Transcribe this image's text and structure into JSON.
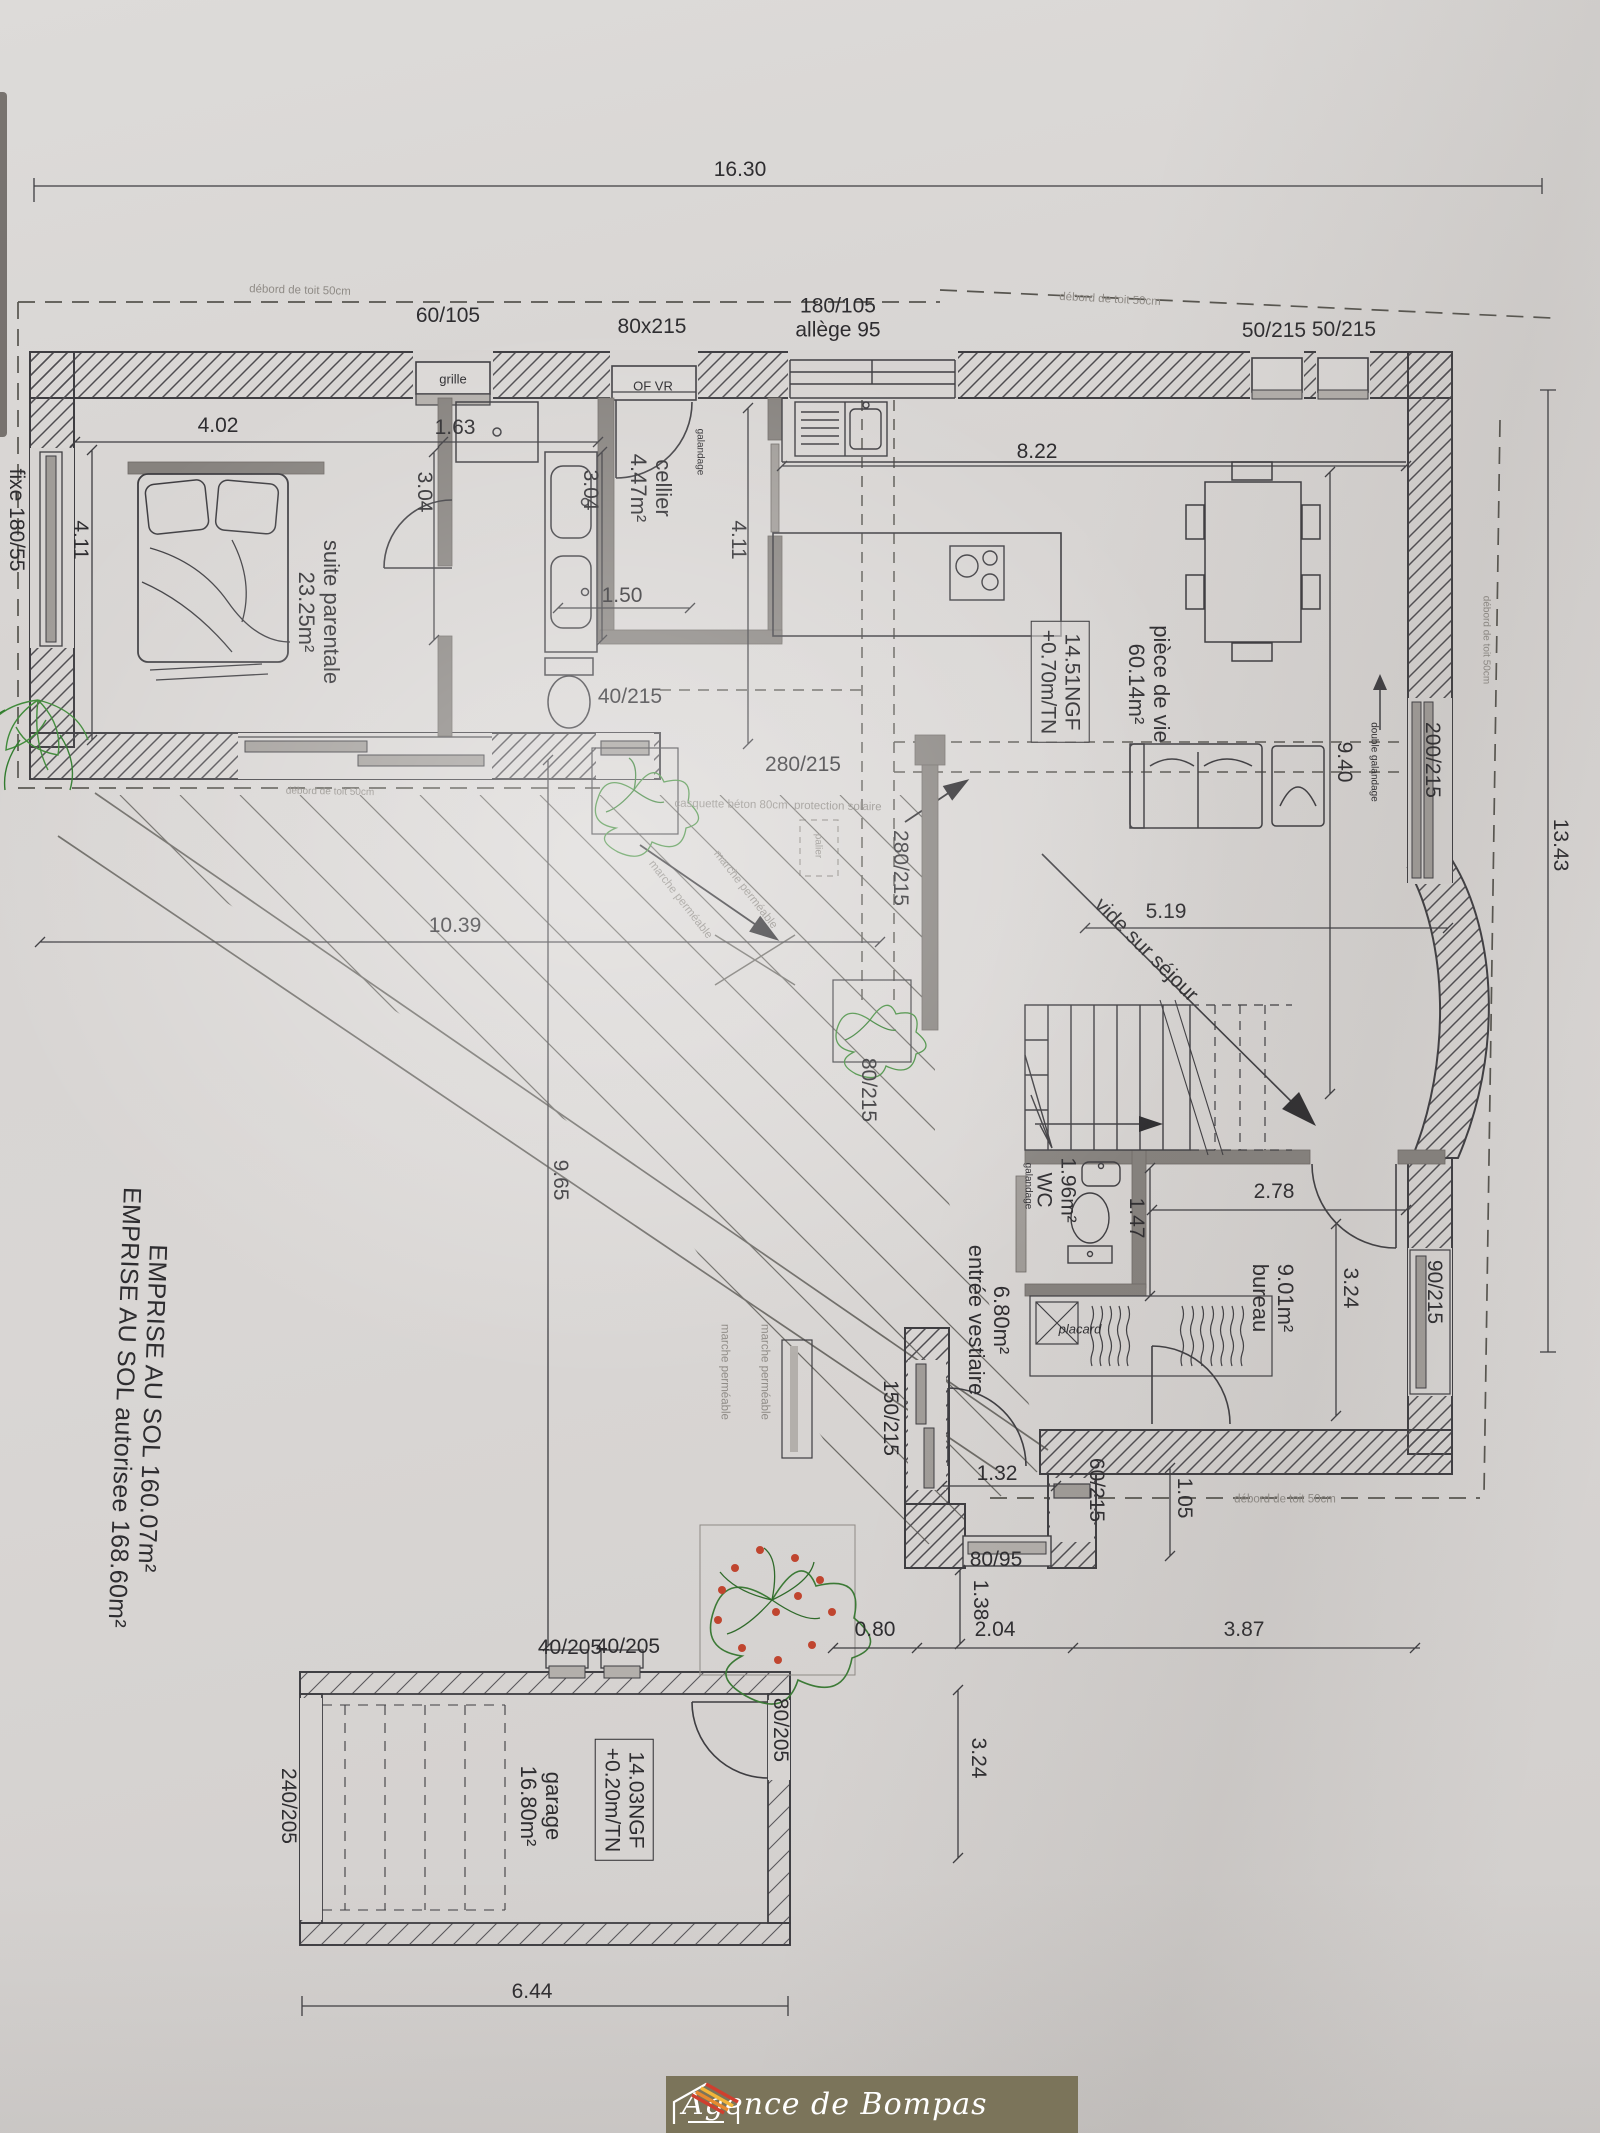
{
  "document": {
    "type": "architectural floor plan photo",
    "summary_line_1": "EMPRISE AU SOL 160.07m²",
    "summary_line_2": "EMPRISE AU SOL autorisee 168.60m²"
  },
  "colors": {
    "paper": "#d7d4d2",
    "ink": "#3e3d41",
    "interior_wall_gray": "#86827e",
    "window_gray": "#a09c98",
    "faint_text": "#8f8b86",
    "plant_green": "#4a8f44",
    "flower_red": "#c0452f",
    "logo_background": "#7b745a",
    "logo_roof_orange": "#e8892f",
    "logo_roof_red": "#cf3f2f"
  },
  "logo": {
    "name": "Agence de Bompas",
    "icon": "house-roof-icon"
  },
  "plan": {
    "labels": [
      {
        "name": "dim-16-30",
        "text": "16.30",
        "x": 740,
        "y": 170,
        "rot": 0,
        "cls": ""
      },
      {
        "name": "win-60-105",
        "text": "60/105",
        "x": 448,
        "y": 316,
        "rot": 0,
        "cls": ""
      },
      {
        "name": "grille-note",
        "text": "grille",
        "x": 453,
        "y": 380,
        "rot": 0,
        "cls": "t12"
      },
      {
        "name": "win-80x215",
        "text": "80x215",
        "x": 652,
        "y": 327,
        "rot": 0,
        "cls": ""
      },
      {
        "name": "of-vr-note",
        "text": "OF VR",
        "x": 653,
        "y": 387,
        "rot": 0,
        "cls": "t12"
      },
      {
        "name": "win-180-105",
        "text": "180/105\nallège 95",
        "x": 838,
        "y": 318,
        "rot": 0,
        "cls": ""
      },
      {
        "name": "win-50-215-a",
        "text": "50/215",
        "x": 1274,
        "y": 331,
        "rot": 0,
        "cls": ""
      },
      {
        "name": "win-50-215-b",
        "text": "50/215",
        "x": 1344,
        "y": 330,
        "rot": 0,
        "cls": ""
      },
      {
        "name": "deb-toit-1",
        "text": "débord de toit 50cm",
        "x": 300,
        "y": 291,
        "rot": 1.5,
        "cls": "t11 gray"
      },
      {
        "name": "deb-toit-2",
        "text": "débord de toit 50cm",
        "x": 1110,
        "y": 300,
        "rot": 3,
        "cls": "t11 gray"
      },
      {
        "name": "deb-toit-3",
        "text": "débord de toit 50cm",
        "x": 1486,
        "y": 640,
        "rot": 90,
        "cls": "t10 gray"
      },
      {
        "name": "deb-toit-4",
        "text": "débord de toit 50cm",
        "x": 330,
        "y": 792,
        "rot": 1,
        "cls": "t10 gray"
      },
      {
        "name": "dim-4-02",
        "text": "4.02",
        "x": 218,
        "y": 426,
        "rot": 0,
        "cls": ""
      },
      {
        "name": "dim-1-63",
        "text": "1.63",
        "x": 455,
        "y": 428,
        "rot": 0,
        "cls": ""
      },
      {
        "name": "dim-3-04-a",
        "text": "3.04",
        "x": 424,
        "y": 492,
        "rot": 90,
        "cls": ""
      },
      {
        "name": "dim-3-04-b",
        "text": "3.04",
        "x": 590,
        "y": 490,
        "rot": 90,
        "cls": ""
      },
      {
        "name": "win-fixe-180-55",
        "text": "fixe 180/55",
        "x": 16,
        "y": 520,
        "rot": 90,
        "cls": ""
      },
      {
        "name": "dim-4-11-a",
        "text": "4.11",
        "x": 80,
        "y": 540,
        "rot": 90,
        "cls": ""
      },
      {
        "name": "room-suite-parentale",
        "text": "suite parentale\n23.25m²",
        "x": 318,
        "y": 612,
        "rot": 90,
        "cls": "big"
      },
      {
        "name": "room-cellier",
        "text": "cellier\n4.47m²",
        "x": 650,
        "y": 488,
        "rot": 90,
        "cls": "big"
      },
      {
        "name": "galandage-a",
        "text": "galandage",
        "x": 700,
        "y": 452,
        "rot": 90,
        "cls": "t10"
      },
      {
        "name": "dim-4-11-b",
        "text": "4.11",
        "x": 738,
        "y": 540,
        "rot": 90,
        "cls": ""
      },
      {
        "name": "dim-1-50",
        "text": "1.50",
        "x": 622,
        "y": 596,
        "rot": 0,
        "cls": ""
      },
      {
        "name": "dim-8-22",
        "text": "8.22",
        "x": 1037,
        "y": 452,
        "rot": 0,
        "cls": ""
      },
      {
        "name": "ngf-main",
        "text": "14.51NGF\n+0.70m/TN",
        "x": 1060,
        "y": 682,
        "rot": 90,
        "cls": "boxed"
      },
      {
        "name": "room-piece-de-vie",
        "text": "pièce de vie\n60.14m²",
        "x": 1148,
        "y": 684,
        "rot": 90,
        "cls": "big"
      },
      {
        "name": "dim-9-40",
        "text": "9.40",
        "x": 1344,
        "y": 762,
        "rot": 90,
        "cls": ""
      },
      {
        "name": "dbl-galandage",
        "text": "double galandage",
        "x": 1374,
        "y": 762,
        "rot": 90,
        "cls": "t10"
      },
      {
        "name": "win-200-215",
        "text": "200/215",
        "x": 1432,
        "y": 760,
        "rot": 90,
        "cls": ""
      },
      {
        "name": "dim-13-43",
        "text": "13.43",
        "x": 1560,
        "y": 845,
        "rot": 90,
        "cls": ""
      },
      {
        "name": "win-40-215",
        "text": "40/215",
        "x": 630,
        "y": 697,
        "rot": 0,
        "cls": ""
      },
      {
        "name": "win-280-215-h",
        "text": "280/215",
        "x": 803,
        "y": 765,
        "rot": 0,
        "cls": ""
      },
      {
        "name": "casquette-note",
        "text": "casquette béton 80cm  protection solaire",
        "x": 778,
        "y": 806,
        "rot": 1,
        "cls": "t11 gray"
      },
      {
        "name": "palier-note",
        "text": "palier",
        "x": 818,
        "y": 846,
        "rot": 90,
        "cls": "t10 gray"
      },
      {
        "name": "win-280-215-v",
        "text": "280/215",
        "x": 900,
        "y": 868,
        "rot": 90,
        "cls": ""
      },
      {
        "name": "marche-1",
        "text": "marche perméable",
        "x": 745,
        "y": 890,
        "rot": 52,
        "cls": "t11 gray"
      },
      {
        "name": "marche-2",
        "text": "marche perméable",
        "x": 680,
        "y": 900,
        "rot": 52,
        "cls": "t11 gray"
      },
      {
        "name": "dim-10-39",
        "text": "10.39",
        "x": 455,
        "y": 926,
        "rot": 0,
        "cls": ""
      },
      {
        "name": "dim-5-19",
        "text": "5.19",
        "x": 1166,
        "y": 912,
        "rot": 0,
        "cls": ""
      },
      {
        "name": "vide-sur-sejour",
        "text": "vide sur séjour",
        "x": 1146,
        "y": 950,
        "rot": 45,
        "cls": ""
      },
      {
        "name": "win-80-215",
        "text": "80/215",
        "x": 868,
        "y": 1090,
        "rot": 90,
        "cls": ""
      },
      {
        "name": "dim-9-65",
        "text": "9.65",
        "x": 560,
        "y": 1180,
        "rot": 90,
        "cls": ""
      },
      {
        "name": "galandage-b",
        "text": "galandage",
        "x": 1028,
        "y": 1186,
        "rot": 90,
        "cls": "t10"
      },
      {
        "name": "room-wc",
        "text": "1.96m²\nWC",
        "x": 1056,
        "y": 1190,
        "rot": 90,
        "cls": ""
      },
      {
        "name": "dim-1-47",
        "text": "1.47",
        "x": 1136,
        "y": 1218,
        "rot": 90,
        "cls": ""
      },
      {
        "name": "dim-2-78",
        "text": "2.78",
        "x": 1274,
        "y": 1192,
        "rot": 0,
        "cls": ""
      },
      {
        "name": "room-bureau",
        "text": "9.01m²\nbureau",
        "x": 1272,
        "y": 1298,
        "rot": 90,
        "cls": "big"
      },
      {
        "name": "dim-3-24-a",
        "text": "3.24",
        "x": 1350,
        "y": 1288,
        "rot": 90,
        "cls": ""
      },
      {
        "name": "win-90-215",
        "text": "90/215",
        "x": 1434,
        "y": 1292,
        "rot": 90,
        "cls": ""
      },
      {
        "name": "room-entree",
        "text": "6.80m²\nentrée vestiaire",
        "x": 988,
        "y": 1320,
        "rot": 90,
        "cls": "big"
      },
      {
        "name": "placard-note",
        "text": "placard",
        "x": 1080,
        "y": 1330,
        "rot": 0,
        "cls": "t12 italic"
      },
      {
        "name": "win-150-215",
        "text": "150/215",
        "x": 890,
        "y": 1418,
        "rot": 90,
        "cls": ""
      },
      {
        "name": "marche-3",
        "text": "marche perméable",
        "x": 724,
        "y": 1372,
        "rot": 90,
        "cls": "t11 gray"
      },
      {
        "name": "marche-4",
        "text": "marche perméable",
        "x": 764,
        "y": 1372,
        "rot": 90,
        "cls": "t11 gray"
      },
      {
        "name": "dim-1-32",
        "text": "1.32",
        "x": 997,
        "y": 1474,
        "rot": 0,
        "cls": ""
      },
      {
        "name": "win-60-215",
        "text": "60/215",
        "x": 1096,
        "y": 1490,
        "rot": 90,
        "cls": ""
      },
      {
        "name": "dim-1-05",
        "text": "1.05",
        "x": 1184,
        "y": 1498,
        "rot": 90,
        "cls": ""
      },
      {
        "name": "deb-toit-5",
        "text": "débord de toit 50cm",
        "x": 1285,
        "y": 1500,
        "rot": 0,
        "cls": "t11 gray"
      },
      {
        "name": "win-80-95",
        "text": "80/95",
        "x": 996,
        "y": 1560,
        "rot": 0,
        "cls": ""
      },
      {
        "name": "dim-1-38",
        "text": "1.38",
        "x": 980,
        "y": 1600,
        "rot": 90,
        "cls": ""
      },
      {
        "name": "dim-0-80",
        "text": "0.80",
        "x": 875,
        "y": 1630,
        "rot": 0,
        "cls": ""
      },
      {
        "name": "dim-2-04",
        "text": "2.04",
        "x": 995,
        "y": 1630,
        "rot": 0,
        "cls": ""
      },
      {
        "name": "dim-3-87",
        "text": "3.87",
        "x": 1244,
        "y": 1630,
        "rot": 0,
        "cls": ""
      },
      {
        "name": "win-40-205-a",
        "text": "40/205",
        "x": 570,
        "y": 1648,
        "rot": 0,
        "cls": ""
      },
      {
        "name": "win-40-205-b",
        "text": "40/205",
        "x": 628,
        "y": 1647,
        "rot": 0,
        "cls": ""
      },
      {
        "name": "door-240-205",
        "text": "240/205",
        "x": 288,
        "y": 1806,
        "rot": 90,
        "cls": ""
      },
      {
        "name": "room-garage",
        "text": "garage\n16.80m²",
        "x": 540,
        "y": 1806,
        "rot": 90,
        "cls": "big"
      },
      {
        "name": "ngf-garage",
        "text": "14.03NGF\n+0.20m/TN",
        "x": 624,
        "y": 1800,
        "rot": 90,
        "cls": "boxed"
      },
      {
        "name": "door-80-205",
        "text": "80/205",
        "x": 780,
        "y": 1730,
        "rot": 90,
        "cls": ""
      },
      {
        "name": "dim-3-24-b",
        "text": "3.24",
        "x": 978,
        "y": 1758,
        "rot": 90,
        "cls": ""
      },
      {
        "name": "dim-6-44",
        "text": "6.44",
        "x": 532,
        "y": 1992,
        "rot": 0,
        "cls": ""
      },
      {
        "name": "emprise-note",
        "text": "EMPRISE AU SOL 160.07m²\nEMPRISE AU SOL autorisee 168.60m²",
        "x": 138,
        "y": 1408,
        "rot": 92,
        "cls": "emprise"
      }
    ]
  }
}
